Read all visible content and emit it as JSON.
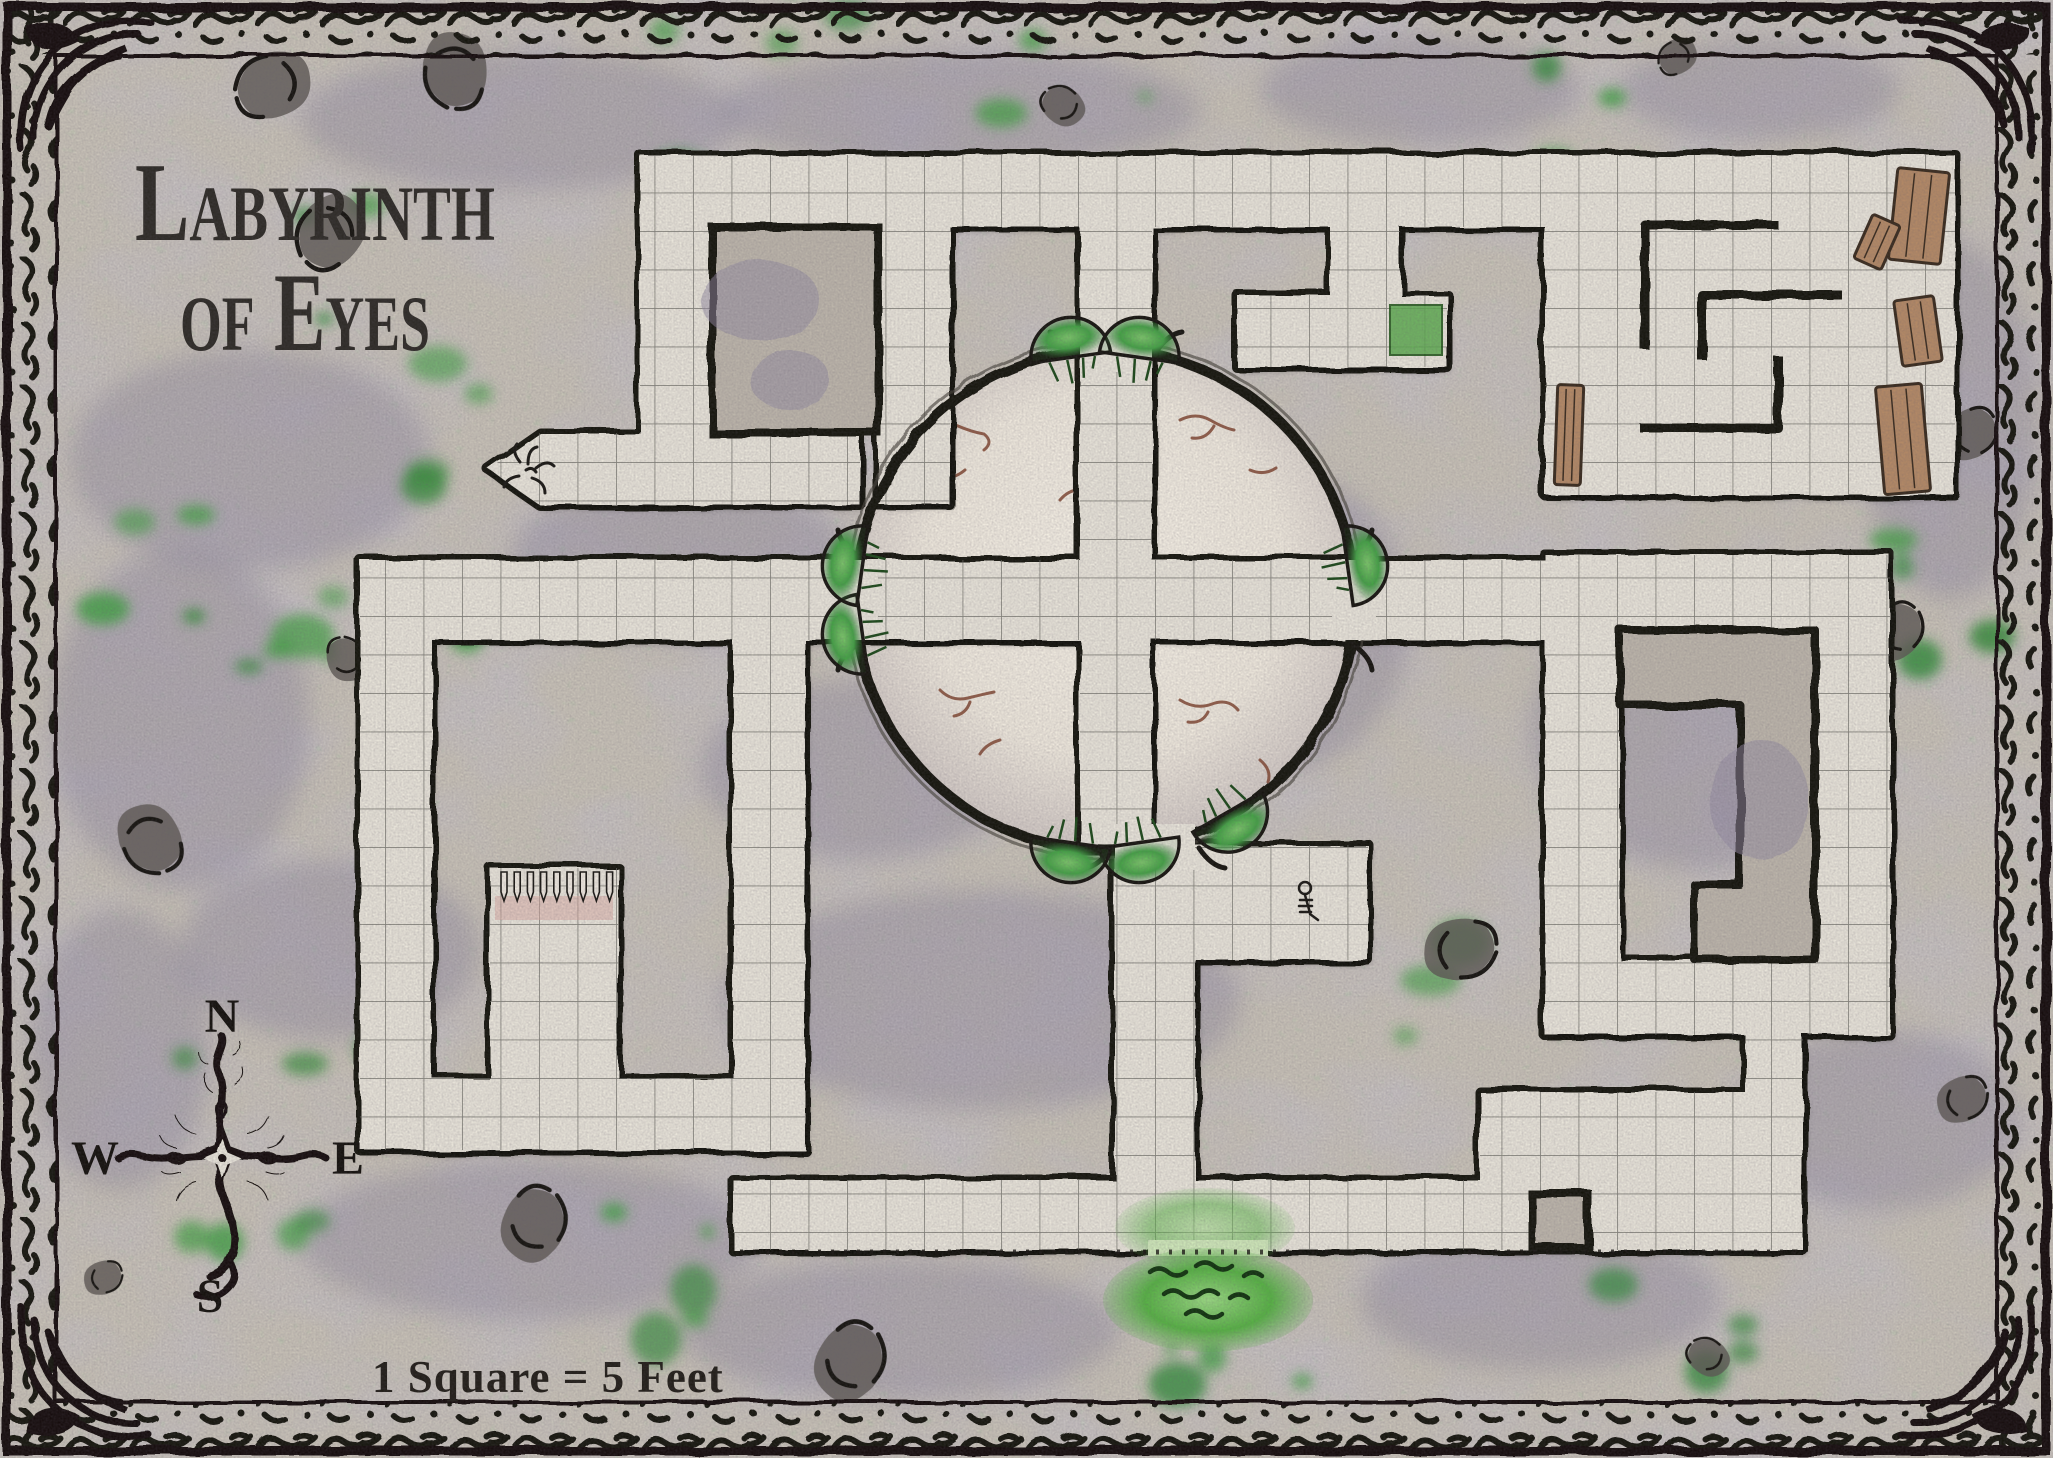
{
  "map": {
    "title_line1": "Labyrinth",
    "title_line2": "of Eyes",
    "scale_label": "1 Square = 5 Feet",
    "compass": {
      "north": "N",
      "east": "E",
      "south": "S",
      "west": "W"
    },
    "grid_note": "square grid, 1 square = 5 feet",
    "colors": {
      "ink": "#17150f",
      "rock_base": "#c9c3b8",
      "rock_mottle": "#8e87a0",
      "corridor_floor": "#e9e5da",
      "chamber_floor": "#f2ede2",
      "chamber_crack": "#80452f",
      "grid_line": "#6e6e66",
      "moss_green": "#3f9e3f",
      "slime_green": "#57b244",
      "wood_debris": "#b48a66",
      "title_ink": "#2e2b26"
    },
    "features": [
      "ornate-ink-border-frame",
      "compass-rose-icon",
      "central-circular-chamber",
      "cross-corridor-in-chamber",
      "mossy-doorways",
      "spiked-pit-room",
      "slime-pool",
      "skeleton-remains-icon",
      "tentacle-marking-icon",
      "wooden-debris",
      "spiral-baffle-walls",
      "moss-patches",
      "rubble-patches"
    ]
  }
}
